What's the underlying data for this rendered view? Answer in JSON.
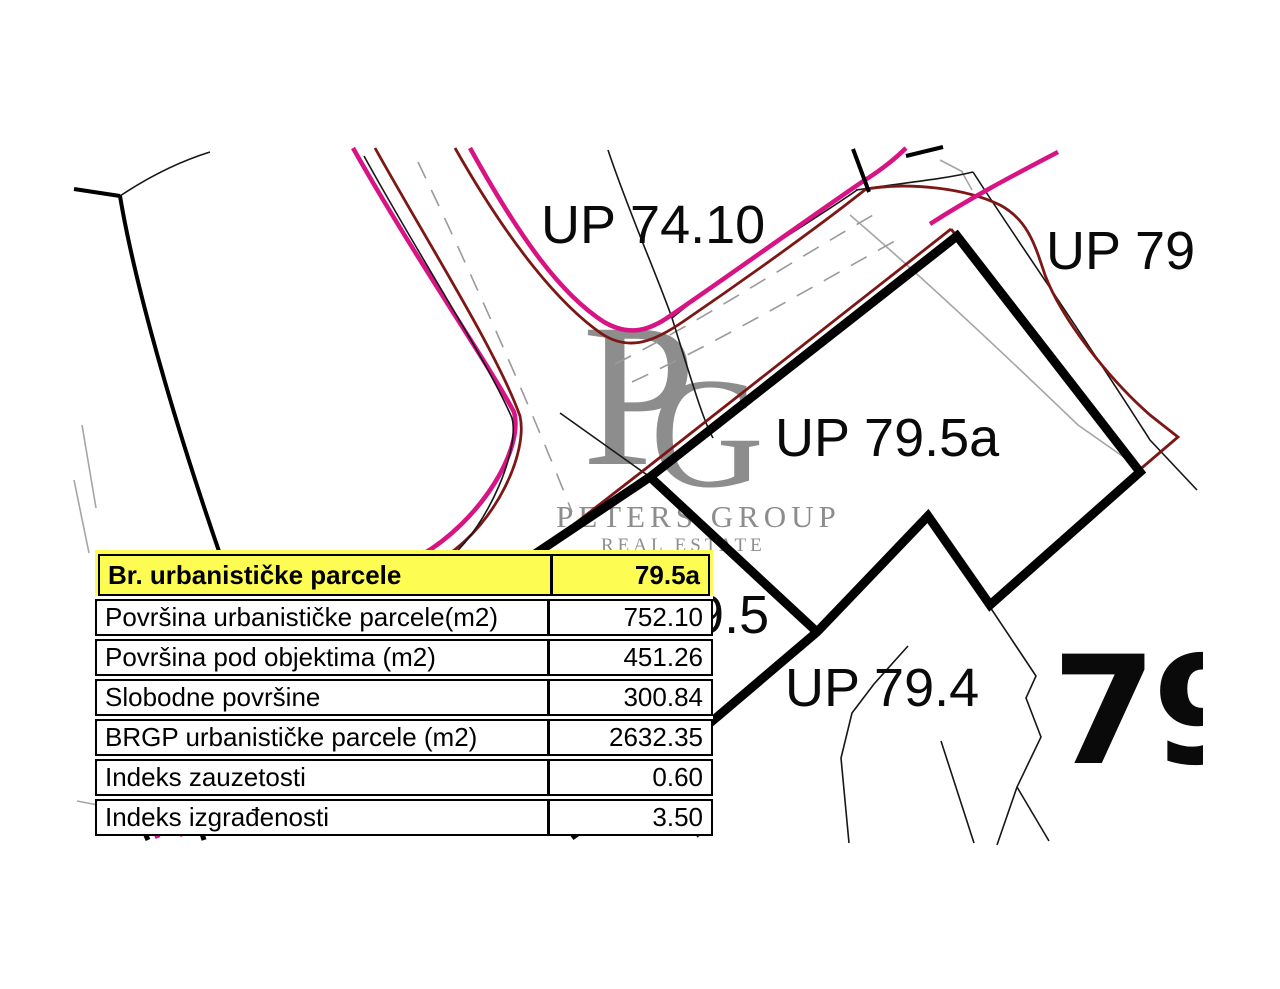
{
  "map": {
    "labels": {
      "up_74_10": "UP 74.10",
      "up_79": "UP 79",
      "up_79_5a": "UP 79.5a",
      "p_79_5": "79.5",
      "up_79_4": "UP 79.4",
      "big_79": "79"
    },
    "colors": {
      "parcel_boundary": "#000000",
      "road_edge_magenta": "#d81384",
      "existing_line_dark_red": "#7c1715",
      "cadastral_thin_black": "#161616",
      "centerline_gray": "#9a9a9a",
      "table_header_yellow": "#fcfc52"
    }
  },
  "watermark": {
    "monogram_p": "P",
    "monogram_g": "G",
    "line1": "PETERS GROUP",
    "line2": "REAL ESTATE",
    "color": "#8d8d8d"
  },
  "table": {
    "header": {
      "label": "Br. urbanističke parcele",
      "value": "79.5a"
    },
    "rows": [
      {
        "label": "Površina urbanističke parcele(m2)",
        "value": "752.10"
      },
      {
        "label": "Površina pod objektima (m2)",
        "value": "451.26"
      },
      {
        "label": "Slobodne površine",
        "value": "300.84"
      },
      {
        "label": "BRGP urbanističke parcele (m2)",
        "value": "2632.35"
      },
      {
        "label": "Indeks zauzetosti",
        "value": "0.60"
      },
      {
        "label": "Indeks izgrađenosti",
        "value": "3.50"
      }
    ]
  }
}
